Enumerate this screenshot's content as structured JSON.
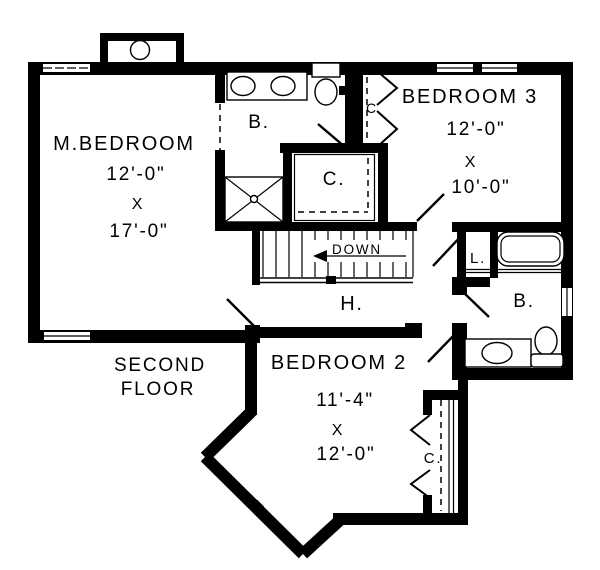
{
  "plan": {
    "floor": {
      "line1": "SECOND",
      "line2": "FLOOR"
    },
    "stairs": {
      "direction": "DOWN"
    },
    "rooms": {
      "master_bedroom": {
        "name": "M.BEDROOM",
        "width": "12'-0\"",
        "times": "X",
        "length": "17'-0\""
      },
      "bedroom_3": {
        "name": "BEDROOM 3",
        "width": "12'-0\"",
        "times": "X",
        "length": "10'-0\""
      },
      "bedroom_2": {
        "name": "BEDROOM 2",
        "width": "11'-4\"",
        "times": "X",
        "length": "12'-0\""
      }
    },
    "labels": {
      "bathroom_top": "B.",
      "bathroom_right": "B.",
      "closet_top": "C.",
      "closet_bedroom3": "C",
      "closet_bedroom2": "C.",
      "linen": "L.",
      "hall": "H."
    },
    "colors": {
      "line": "#000000",
      "background": "#ffffff"
    }
  }
}
